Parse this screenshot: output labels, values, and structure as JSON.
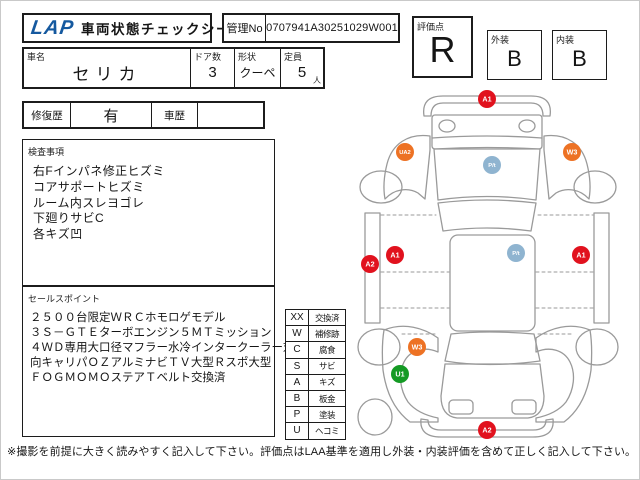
{
  "header": {
    "logo": "LAP",
    "title": "車両状態チェックシート",
    "manage_no_label": "管理No",
    "manage_no_value": "0707941A30251029W001"
  },
  "scores": {
    "overall_label": "評価点",
    "overall_value": "R",
    "exterior_label": "外装",
    "exterior_value": "B",
    "interior_label": "内装",
    "interior_value": "B"
  },
  "vehicle": {
    "name_label": "車名",
    "name_value": "セリカ",
    "doors_label": "ドア数",
    "doors_value": "3",
    "shape_label": "形状",
    "shape_value": "クーペ",
    "capacity_label": "定員",
    "capacity_value": "5",
    "capacity_unit": "人"
  },
  "history": {
    "repair_label": "修復歴",
    "repair_value": "有",
    "car_history_label": "車歴",
    "car_history_value": ""
  },
  "inspection": {
    "label": "検査事項",
    "items": [
      "右Fインパネ修正ヒズミ",
      "コアサポートヒズミ",
      "ルーム内スレヨゴレ",
      "下廻りサビC",
      "各キズ凹"
    ]
  },
  "sales_points": {
    "label": "セールスポイント",
    "lines": [
      "２５００台限定ＷＲＣホモロゲモデル",
      "３Ｓ－ＧＴＥターボエンジン５ＭＴミッション",
      "４ＷＤ専用大口径マフラー水冷インタークーラー対",
      "向キャリパＯＺアルミナビＴＶ大型Ｒスポ大型",
      "ＦＯＧＭＯＭＯステアＴベルト交換済"
    ]
  },
  "legend": {
    "rows": [
      {
        "code": "XX",
        "label": "交換済"
      },
      {
        "code": "W",
        "label": "補修跡"
      },
      {
        "code": "C",
        "label": "腐食"
      },
      {
        "code": "S",
        "label": "サビ"
      },
      {
        "code": "A",
        "label": "キズ"
      },
      {
        "code": "B",
        "label": "板金"
      },
      {
        "code": "P",
        "label": "塗装"
      },
      {
        "code": "U",
        "label": "ヘコミ"
      }
    ]
  },
  "diagram": {
    "colors": {
      "scratch_red": "#e1121e",
      "repair_orange": "#ed7224",
      "paint_blue": "#8fb4d0",
      "dent_green": "#149a24",
      "outline_gray": "#9a9a9a"
    },
    "markers": [
      {
        "label": "A1",
        "color": "#e1121e",
        "x": 139,
        "y": 13
      },
      {
        "label": "UA2",
        "color": "#ed7224",
        "x": 57,
        "y": 66
      },
      {
        "label": "W3",
        "color": "#ed7224",
        "x": 224,
        "y": 66
      },
      {
        "label": "P/t",
        "color": "#8fb4d0",
        "x": 144,
        "y": 79
      },
      {
        "label": "A2",
        "color": "#e1121e",
        "x": 22,
        "y": 178
      },
      {
        "label": "A1",
        "color": "#e1121e",
        "x": 47,
        "y": 169
      },
      {
        "label": "P/t",
        "color": "#8fb4d0",
        "x": 168,
        "y": 167
      },
      {
        "label": "A1",
        "color": "#e1121e",
        "x": 233,
        "y": 169
      },
      {
        "label": "W3",
        "color": "#ed7224",
        "x": 69,
        "y": 261
      },
      {
        "label": "U1",
        "color": "#149a24",
        "x": 52,
        "y": 288
      },
      {
        "label": "A2",
        "color": "#e1121e",
        "x": 139,
        "y": 344
      }
    ]
  },
  "footer": {
    "note": "※撮影を前提に大きく読みやすく記入して下さい。評価点はLAA基準を適用し外装・内装評価を含めて正しく記入して下さい。"
  }
}
